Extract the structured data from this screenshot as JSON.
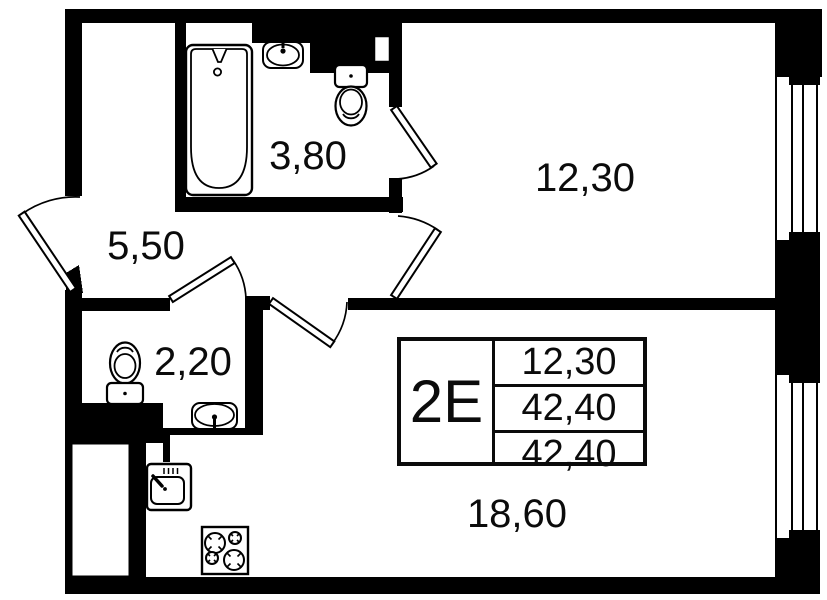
{
  "title": "Apartment floor plan",
  "unit": {
    "label": "2E",
    "stats": [
      "12,30",
      "42,40",
      "42,40"
    ]
  },
  "rooms": {
    "bathroom": {
      "area": "3,80"
    },
    "hallway": {
      "area": "5,50"
    },
    "bedroom": {
      "area": "12,30"
    },
    "wc": {
      "area": "2,20"
    },
    "kitchen_living": {
      "area": "18,60"
    }
  },
  "icons": [
    "bathtub-icon",
    "bath-sink-icon",
    "bath-toilet-icon",
    "wc-toilet-icon",
    "wc-sink-icon",
    "kitchen-sink-icon",
    "stove-icon",
    "window-icon",
    "door-swing-icon",
    "ventilation-shaft-icon"
  ],
  "colors": {
    "wall": "#000000",
    "floor": "#ffffff",
    "text": "#0b0b0b"
  }
}
